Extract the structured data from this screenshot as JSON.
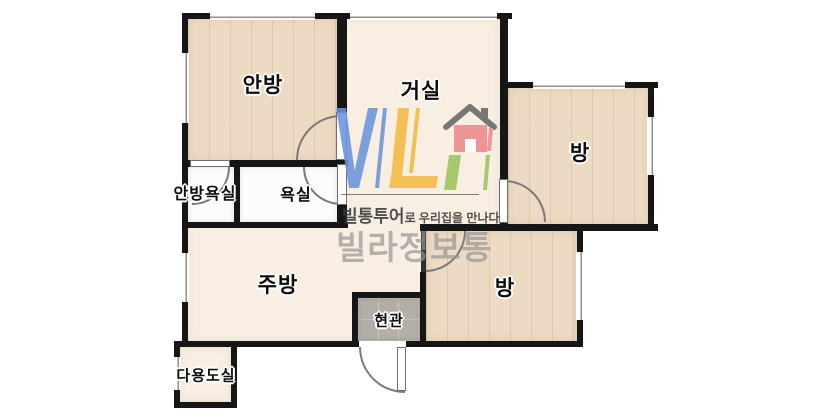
{
  "plan": {
    "rooms": [
      {
        "name": "master-bedroom",
        "label": "안방"
      },
      {
        "name": "living-room",
        "label": "거실"
      },
      {
        "name": "room-right",
        "label": "방"
      },
      {
        "name": "master-bathroom",
        "label": "안방욕실"
      },
      {
        "name": "bathroom",
        "label": "욕실"
      },
      {
        "name": "kitchen",
        "label": "주방"
      },
      {
        "name": "entrance",
        "label": "현관"
      },
      {
        "name": "room-bottom",
        "label": "방"
      },
      {
        "name": "utility-room",
        "label": "다용도실"
      }
    ]
  },
  "watermark": {
    "logo_letters": "VL",
    "logo_icon": "house-icon",
    "tagline_bold": "빌통투어",
    "tagline_rest": "로 우리집을 만나다",
    "brand": "빌라정보통",
    "colors": {
      "blue": "#6a93dd",
      "yellow": "#f4b942",
      "house_red": "#ee8a8a",
      "house_green": "#9cc45f",
      "roof_gray": "#666666",
      "underline_gray": "#707070"
    }
  },
  "palette": {
    "wall": "#161616",
    "wood_floor": "#ecdac2",
    "cream_floor": "#f8efe2",
    "bath_floor": "#fbfbfb",
    "entry_tile": "#b3aea6"
  }
}
